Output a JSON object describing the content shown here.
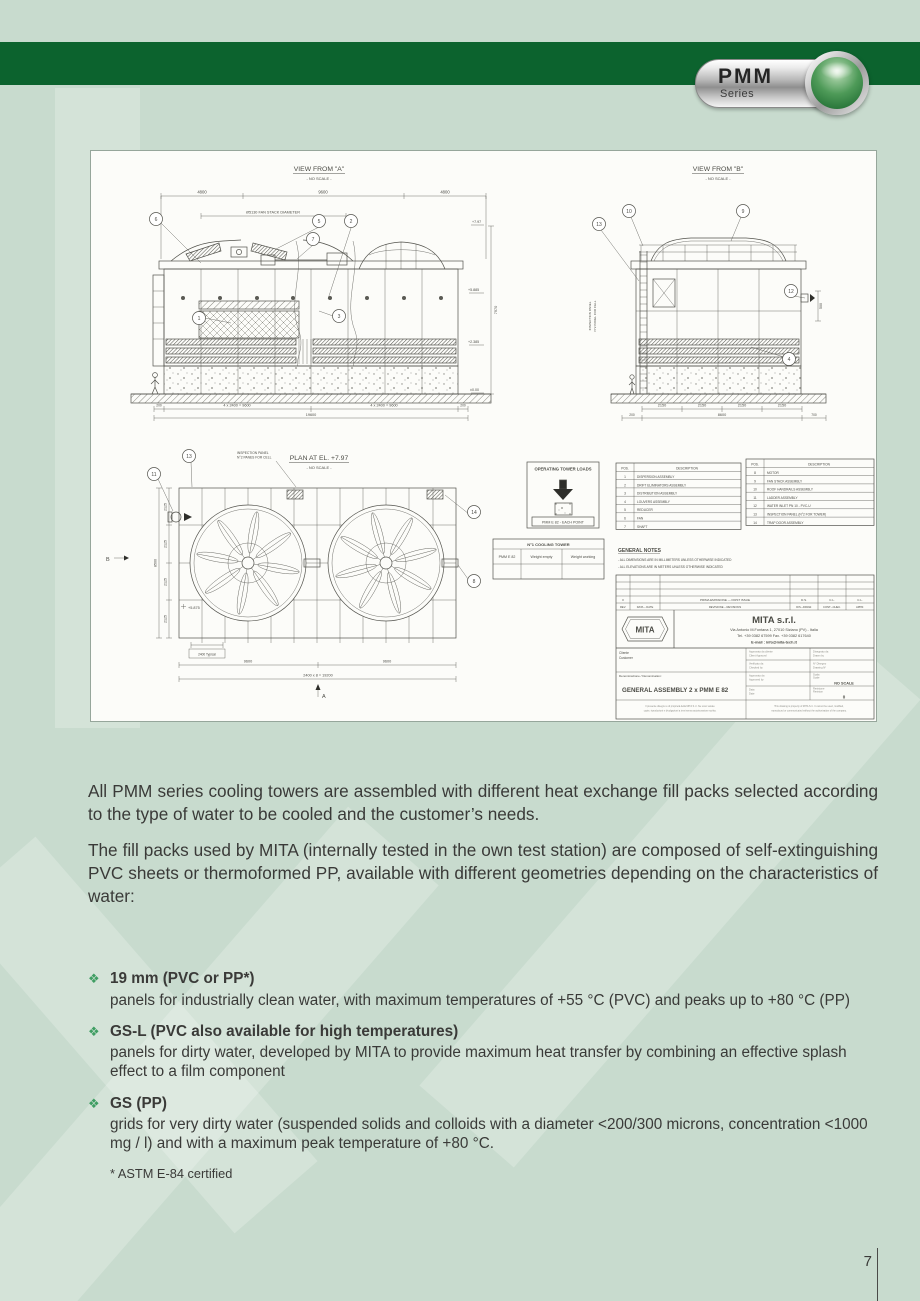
{
  "page": {
    "number": "7"
  },
  "badge": {
    "title": "PMM",
    "subtitle": "Series"
  },
  "colors": {
    "header_green": "#0c632e",
    "page_bg": "#c8dbce",
    "bullet_green": "#3f9e63"
  },
  "paragraphs": {
    "p1": "All PMM series cooling towers are assembled with different heat exchange fill packs selected according to the type of water to be cooled and the customer’s needs.",
    "p2": "The fill packs used by MITA (internally tested in the own test station) are composed of self-extinguishing PVC sheets or thermoformed PP, available with different geometries depending on the characteristics of water:"
  },
  "bullets": [
    {
      "marker": "❖",
      "title": "19 mm (PVC or PP*)",
      "body": "panels for industrially clean water, with maximum temperatures of +55 °C (PVC) and peaks up to +80 °C (PP)"
    },
    {
      "marker": "❖",
      "title": "GS-L (PVC also available for high temperatures)",
      "body": "panels for dirty water, developed by MITA to provide maximum heat transfer by combining an effective splash effect to a film component"
    },
    {
      "marker": "❖",
      "title": "GS (PP)",
      "body": "grids for very dirty water (suspended solids and colloids with a diameter <200/300 microns, concentration <1000 mg / l) and with a maximum peak temperature of +80 °C."
    }
  ],
  "footnote": "* ASTM E-84 certified",
  "drawing": {
    "view_a": {
      "title": "VIEW FROM \"A\"",
      "no_scale": "- NO SCALE -",
      "fan_stack_dim": "Ø5130 FAN STACK DIAMETER",
      "top_dims": [
        "4800",
        "9600",
        "4800"
      ],
      "bottom_dims": [
        "200",
        "4 x 2400 = 9600",
        "4 x 2400 = 9600",
        "200"
      ],
      "total_dim": "19600",
      "height_dim": "7970",
      "elevations": [
        "+7.97",
        "+5.885",
        "+2.385",
        "±0.00"
      ],
      "balloons": [
        "6",
        "5",
        "2",
        "7",
        "1",
        "3"
      ]
    },
    "view_b": {
      "title": "VIEW FROM \"B\"",
      "no_scale": "- NO SCALE -",
      "cell_dims": [
        "2150",
        "2150",
        "2150",
        "2150"
      ],
      "total_dims": [
        "200",
        "8600",
        "700"
      ],
      "side_dim": "500",
      "side_note_1": "INSPECTION PANEL",
      "side_note_2": "N°2 PANEL FOR CELL",
      "balloons": [
        "13",
        "10",
        "9",
        "12",
        "4"
      ]
    },
    "plan": {
      "title": "PLAN AT EL. +7.97",
      "no_scale": "- NO SCALE -",
      "note_1": "INSPECTION PANEL",
      "note_2": "N°2 PANES FOR CELL",
      "left_dims": [
        "2125",
        "2125",
        "2125",
        "2125"
      ],
      "left_total": "8500",
      "bottom_dims": [
        "9600",
        "9600"
      ],
      "bottom_total": "2400 x 8 = 19200",
      "typical_dim": "2400 Typical",
      "elevation_mark": "+5.875",
      "section_a": "A",
      "section_b": "B",
      "balloons": [
        "11",
        "13",
        "14",
        "8"
      ]
    },
    "loads_box": {
      "title": "OPERATING TOWER LOADS",
      "label": "PMM E 82 - EACH POINT"
    },
    "weight_table": {
      "title": "N°1 COOLING TOWER",
      "row_label": "PMM E 82",
      "col_empty": "Weight empty",
      "col_working": "Weight working"
    },
    "parts1": {
      "header_pos": "POS.",
      "header_desc": "DESCRIPTION",
      "rows": [
        [
          "1",
          "DISPERSION ASSEMBLY"
        ],
        [
          "2",
          "DRIFT ELIMINATORS ASSEMBLY"
        ],
        [
          "3",
          "DISTRIBUTION ASSEMBLY"
        ],
        [
          "4",
          "LOUVERS ASSEMBLY"
        ],
        [
          "5",
          "REDUCER"
        ],
        [
          "6",
          "FAN"
        ],
        [
          "7",
          "SHAFT"
        ]
      ]
    },
    "parts2": {
      "header_pos": "POS.",
      "header_desc": "DESCRIPTION",
      "rows": [
        [
          "8",
          "MOTOR"
        ],
        [
          "9",
          "FAN STACK ASSEMBLY"
        ],
        [
          "10",
          "ROOF HANDRAILS ASSEMBLY"
        ],
        [
          "11",
          "LADDER ASSEMBLY"
        ],
        [
          "12",
          "WATER INLET PN 10 - PVC-U"
        ],
        [
          "13",
          "INSPECTION PANEL (N°2 FOR TOWER)"
        ],
        [
          "14",
          "TRAP DOOR ASSEMBLY"
        ]
      ]
    },
    "general_notes": {
      "title": "GENERAL NOTES",
      "note_1": "- ALL DIMENSIONS ARE IN MILLIMETERS UNLESS OTHERWISE INDICATED",
      "note_2": "- ALL ELEVATIONS ARE IN METERS UNLESS OTHERWISE INDICATED"
    },
    "title_block": {
      "rev_no": "0",
      "rev_desc": "PRIMA EMISSIONE — FIRST ISSUE",
      "rev_sign_1": "D.S.",
      "rev_sign_2": "C.L.",
      "rev_sign_3": "C.L.",
      "rev_labels": [
        "REV.",
        "DATA – DATE",
        "REVISIONE – REVISIONS",
        "DIS.–DRAW.",
        "CONT.–CHEC.",
        "APPR."
      ],
      "logo_text": "MITA",
      "company": "MITA s.r.l.",
      "address": "Via Antonio M.Fontana 1, 27010 Siziano (PV) - Italia",
      "phone": "Tel. +39 0382 67599 Fax. +39 0382 617640",
      "email": "E-mail : info@mita-tech.it",
      "client_it": "Cliente",
      "client_en": "Customer",
      "denomination_label": "Denominazione / Denomination:",
      "denomination": "GENERAL ASSEMBLY  2 x PMM E 82",
      "scale": "NO SCALE",
      "sheet": "0",
      "small_labels": [
        "Approvato da cliente",
        "Client Approval",
        "Disegnato da",
        "Drawn by",
        "Verificato da",
        "Checked by",
        "N° Disegno",
        "Drawing N°",
        "Approvato da",
        "Approved by",
        "Scala",
        "Scale",
        "Data",
        "Date",
        "Revisione",
        "Revision"
      ],
      "legal_it_1": "Il presente disegno è di proprietà della MITA S.r.l. Ne sono vietate",
      "legal_it_2": "copie, riproduzioni e divulgazioni a terzi senza autorizzazione scritta.",
      "legal_en_1": "This drawing is property of MITA S.r.l. It cannot be used, modified,",
      "legal_en_2": "reproduced or communicated without the authorization of the company."
    }
  }
}
